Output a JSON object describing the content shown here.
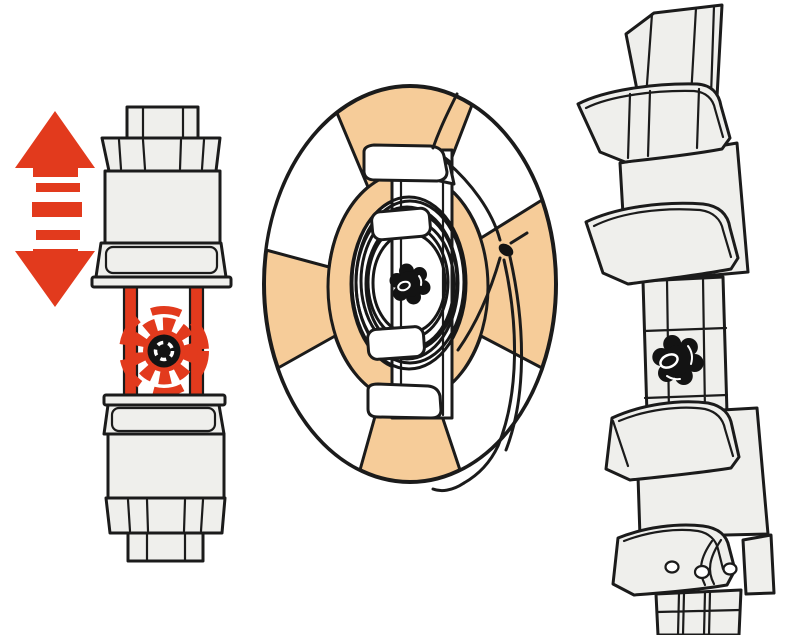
{
  "canvas": {
    "width": 800,
    "height": 635,
    "background": "#ffffff"
  },
  "colors": {
    "accent_red": "#e23a1d",
    "ring_peach": "#f6cc99",
    "part_fill": "#efefec",
    "outline_ink": "#1b1b1b",
    "pure_white": "#ffffff",
    "knob_black": "#131313"
  },
  "figures": {
    "left": {
      "id": "bracket-front-view",
      "icons": [
        "up-down-arrow-icon",
        "locking-knob-red-icon"
      ],
      "shows": "bracket front view with vertical adjustment arrow and red highlighted locking knob"
    },
    "center": {
      "id": "life-ring-front",
      "icons": [
        "life-ring-icon",
        "rope-coil-icon",
        "star-knob-icon",
        "rope-knot-icon"
      ],
      "shows": "life ring with four white bands mounted on bracket with coiled rope"
    },
    "right": {
      "id": "bracket-perspective-view",
      "icons": [
        "star-knob-icon",
        "mounting-holes-icon"
      ],
      "shows": "bracket perspective view with trays, star knob and mounting holes"
    }
  }
}
